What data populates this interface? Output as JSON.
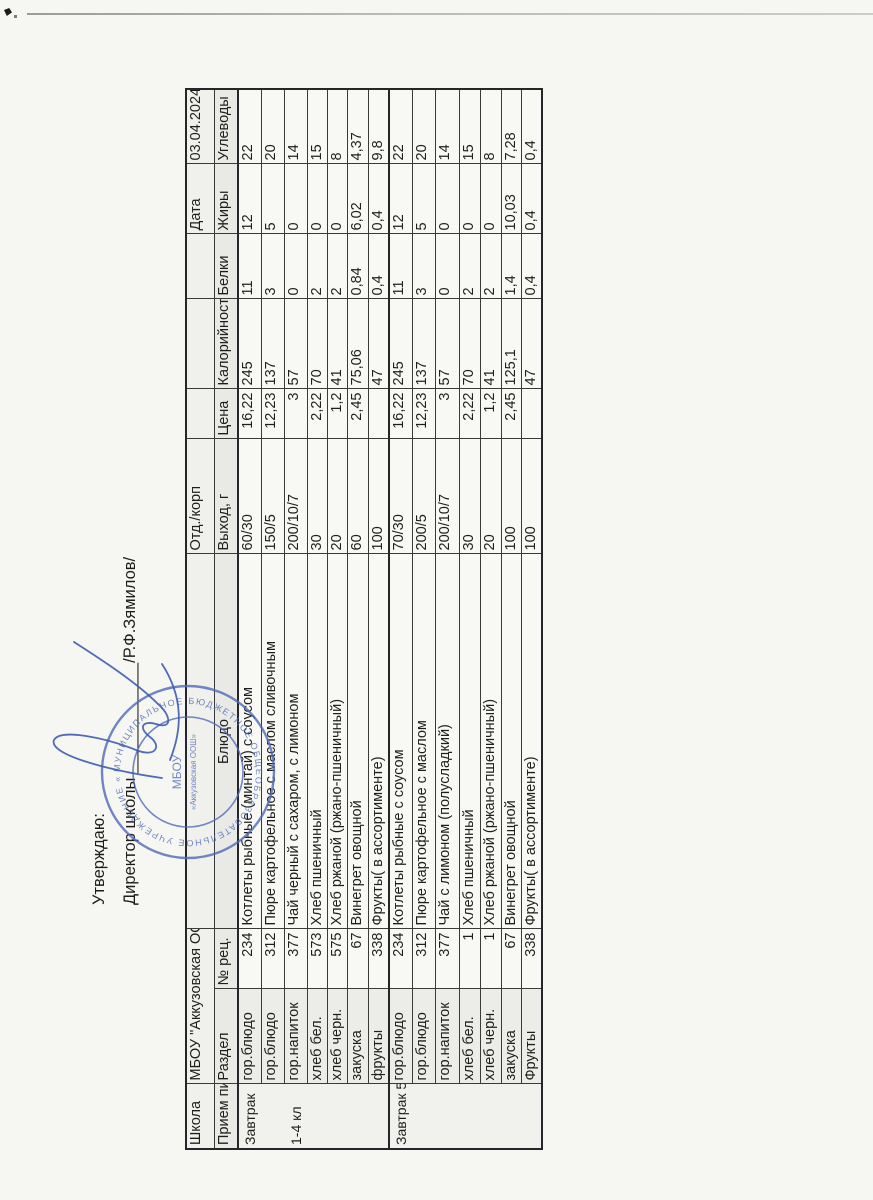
{
  "document": {
    "approve_line": "Утверждаю:",
    "director_prefix": "Директор школы",
    "director_blank": "____________",
    "director_sign": "/Р.Ф.Зямилов/"
  },
  "stamp": {
    "ring_text": "МУНИЦИПАЛЬНОЕ БЮДЖЕТНОЕ ОБЩЕОБРАЗОВАТЕЛЬНОЕ УЧРЕЖДЕНИЕ «АККУЗОВСКАЯ ООШ» • ",
    "center_line1": "МБОУ",
    "center_line2": "«Аккузовская ООШ»",
    "blue": "#4f6ab8"
  },
  "table": {
    "header_row1": {
      "school_label": "Школа",
      "school_name": "МБОУ \"Аккузовская ООШ\"",
      "dept_label": "Отд./корп",
      "date_label": "Дата",
      "date_value": "03.04.2024"
    },
    "header_row2": {
      "meal": "Прием пищи",
      "section": "Раздел",
      "rec": "№ рец.",
      "dish": "Блюдо",
      "out": "Выход, г",
      "price": "Цена",
      "kcal": "Калорийность",
      "protein": "Белки",
      "fat": "Жиры",
      "carb": "Углеводы"
    },
    "groups": [
      {
        "meal_label_1": "Завтрак",
        "meal_label_2": "1-4 кл",
        "rows": [
          {
            "section": "гор.блюдо",
            "num": "234",
            "dish": "Котлеты рыбные (минтай) с соусом",
            "out": "60/30",
            "price": "16,22",
            "kcal": "245",
            "protein": "11",
            "fat": "12",
            "carb": "22"
          },
          {
            "section": "гор.блюдо",
            "num": "312",
            "dish": "Пюре картофельное с маслом сливочным",
            "out": "150/5",
            "price": "12,23",
            "kcal": "137",
            "protein": "3",
            "fat": "5",
            "carb": "20"
          },
          {
            "section": "гор.напиток",
            "num": "377",
            "dish": "Чай черный с сахаром, с лимоном",
            "out": "200/10/7",
            "price": "3",
            "kcal": "57",
            "protein": "0",
            "fat": "0",
            "carb": "14"
          },
          {
            "section": "хлеб бел.",
            "num": "573",
            "dish": "Хлеб пшеничный",
            "out": "30",
            "price": "2,22",
            "kcal": "70",
            "protein": "2",
            "fat": "0",
            "carb": "15"
          },
          {
            "section": "хлеб черн.",
            "num": "575",
            "dish": "Хлеб ржаной (ржано-пшеничный)",
            "out": "20",
            "price": "1,2",
            "kcal": "41",
            "protein": "2",
            "fat": "0",
            "carb": "8"
          },
          {
            "section": "закуска",
            "num": "67",
            "dish": "Винегрет овощной",
            "out": "60",
            "price": "2,45",
            "kcal": "75,06",
            "protein": "0,84",
            "fat": "6,02",
            "carb": "4,37"
          },
          {
            "section": "фрукты",
            "num": "338",
            "dish": "Фрукты( в ассортименте)",
            "out": "100",
            "price": "",
            "kcal": "47",
            "protein": "0,4",
            "fat": "0,4",
            "carb": "9,8"
          }
        ]
      },
      {
        "meal_label_1": "Завтрак 5-9 кл",
        "meal_label_2": "",
        "rows": [
          {
            "section": "гор.блюдо",
            "num": "234",
            "dish": "Котлеты рыбные с соусом",
            "out": "70/30",
            "price": "16,22",
            "kcal": "245",
            "protein": "11",
            "fat": "12",
            "carb": "22"
          },
          {
            "section": "гор.блюдо",
            "num": "312",
            "dish": "Пюре картофельное с маслом",
            "out": "200/5",
            "price": "12,23",
            "kcal": "137",
            "protein": "3",
            "fat": "5",
            "carb": "20"
          },
          {
            "section": "гор.напиток",
            "num": "377",
            "dish": "Чай с лимоном (полусладкий)",
            "out": "200/10/7",
            "price": "3",
            "kcal": "57",
            "protein": "0",
            "fat": "0",
            "carb": "14"
          },
          {
            "section": "хлеб бел.",
            "num": "1",
            "dish": "Хлеб пшеничный",
            "out": "30",
            "price": "2,22",
            "kcal": "70",
            "protein": "2",
            "fat": "0",
            "carb": "15"
          },
          {
            "section": "хлеб черн.",
            "num": "1",
            "dish": "Хлеб ржаной (ржано-пшеничный)",
            "out": "20",
            "price": "1,2",
            "kcal": "41",
            "protein": "2",
            "fat": "0",
            "carb": "8"
          },
          {
            "section": "закуска",
            "num": "67",
            "dish": "Винегрет овощной",
            "out": "100",
            "price": "2,45",
            "kcal": "125,1",
            "protein": "1,4",
            "fat": "10,03",
            "carb": "7,28"
          },
          {
            "section": "Фрукты",
            "num": "338",
            "dish": "Фрукты( в ассортименте)",
            "out": "100",
            "price": "",
            "kcal": "47",
            "protein": "0,4",
            "fat": "0,4",
            "carb": "0,4"
          }
        ]
      }
    ]
  }
}
